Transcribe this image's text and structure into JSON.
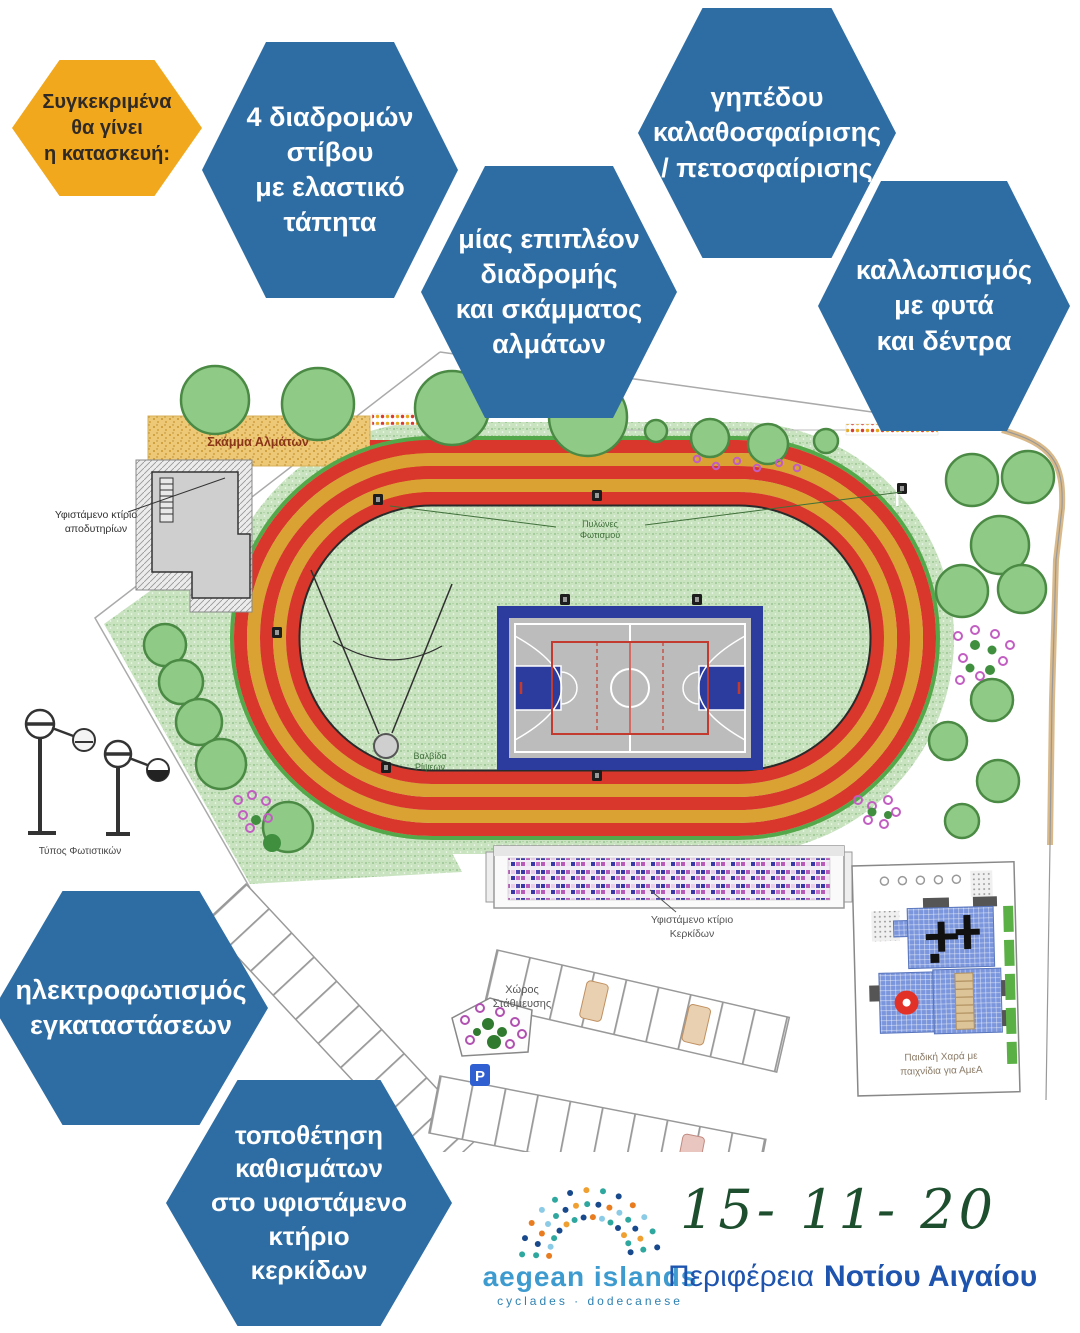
{
  "hexagons": {
    "blue": "#2e6da4",
    "orange": "#f2a81d",
    "intro": {
      "label": "Συγκεκριμένα\nθα γίνει\nη κατασκευή:"
    },
    "items": [
      {
        "label": "4 διαδρομών\nστίβου\nμε ελαστικό\nτάπητα"
      },
      {
        "label": "μίας επιπλέον\nδιαδρομής\nκαι σκάμματος\nαλμάτων"
      },
      {
        "label": "γηπέδου\nκαλαθοσφαίρισης\n/ πετοσφαίρισης"
      },
      {
        "label": "καλλωπισμός\nμε φυτά\nκαι δέντρα"
      },
      {
        "label": "ηλεκτροφωτισμός\nεγκαταστάσεων"
      },
      {
        "label": "τοποθέτηση\nκαθισμάτων\nστο υφιστάμενο\nκτήριο\nκερκίδων"
      }
    ]
  },
  "site_plan": {
    "track_red": "#d9372b",
    "track_gold": "#d9a232",
    "infield_green": "#c9e3c0",
    "court_blue": "#2c3c9e",
    "labels": {
      "sand_pit": "Σκάμμα Αλμάτων",
      "changing_rooms_1": "Υφιστάμενο κτίριο",
      "changing_rooms_2": "αποδυτηρίων",
      "light_pylons_1": "Πυλώνες",
      "light_pylons_2": "Φωτισμού",
      "throwing_1": "Βαλβίδα",
      "throwing_2": "Ρίψεων",
      "stands_1": "Υφιστάμενο κτίριο",
      "stands_2": "Κερκίδων",
      "parking_1": "Χώρος",
      "parking_2": "Στάθμευσης",
      "parking_sign": "P",
      "playground_1": "Παιδική Χαρά με",
      "playground_2": "παιχνίδια για ΑμεΑ",
      "light_type": "Τύπος Φωτιστικών"
    }
  },
  "footer": {
    "logo_title": "aegean islands",
    "logo_subtitle": "cyclades · dodecanese",
    "date": "15- 11- 20",
    "region_prefix": "Περιφέρεια",
    "region_name": "Νοτίου Αιγαίου",
    "date_color": "#1d4f2e",
    "region_color": "#1e54ae"
  }
}
